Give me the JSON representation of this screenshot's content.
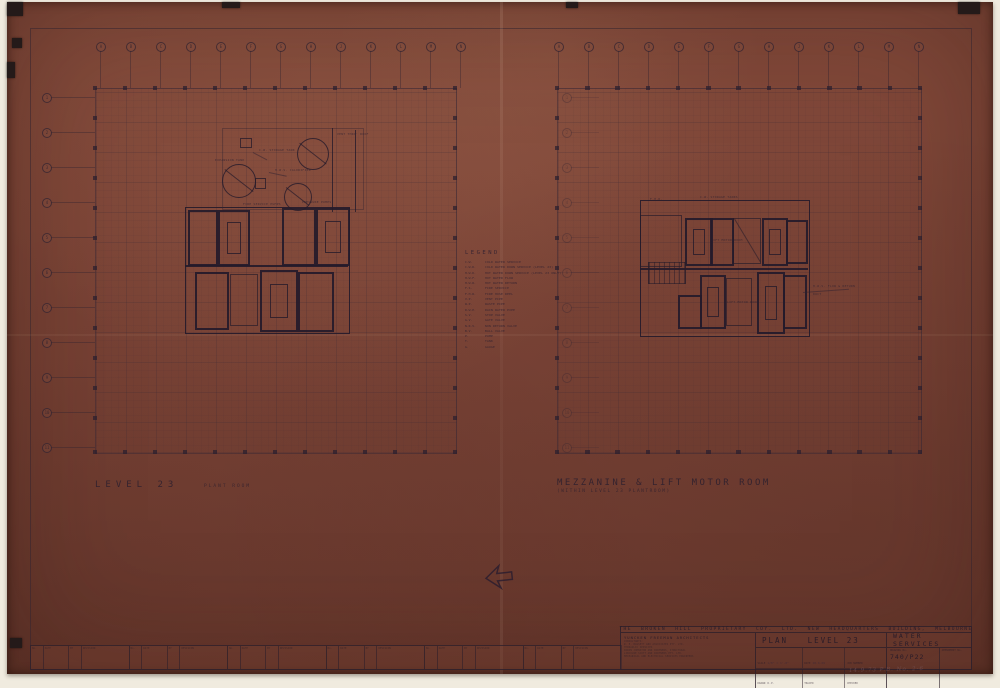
{
  "sheet": {
    "plans": {
      "left": {
        "title": "LEVEL 23",
        "subtitle": "PLANT ROOM"
      },
      "right": {
        "title": "MEZZANINE & LIFT MOTOR ROOM",
        "subtitle": "(WITHIN LEVEL 23 PLANTROOM)"
      }
    },
    "legend": {
      "title": "LEGEND",
      "entries": [
        {
          "abbr": "C.W.",
          "desc": "COLD WATER SERVICE"
        },
        {
          "abbr": "C.W.D.",
          "desc": "COLD WATER DOWN SERVICE (LEVEL 23)"
        },
        {
          "abbr": "H.W.D.",
          "desc": "HOT WATER DOWN SERVICE (LEVEL 23 ONLY)"
        },
        {
          "abbr": "H.W.F.",
          "desc": "HOT WATER FLOW"
        },
        {
          "abbr": "H.W.R.",
          "desc": "HOT WATER RETURN"
        },
        {
          "abbr": "F.S.",
          "desc": "FIRE SERVICE"
        },
        {
          "abbr": "F.H.R.",
          "desc": "FIRE HOSE REEL"
        },
        {
          "abbr": "V.P.",
          "desc": "VENT PIPE"
        },
        {
          "abbr": "W.P.",
          "desc": "WASTE PIPE"
        },
        {
          "abbr": "R.W.P.",
          "desc": "RAIN WATER PIPE"
        },
        {
          "abbr": "S.V.",
          "desc": "STOP VALVE"
        },
        {
          "abbr": "G.V.",
          "desc": "GATE VALVE"
        },
        {
          "abbr": "N.R.V.",
          "desc": "NON RETURN VALVE"
        },
        {
          "abbr": "B.V.",
          "desc": "BALL VALVE"
        },
        {
          "abbr": "P.",
          "desc": "PUMP"
        },
        {
          "abbr": "T.",
          "desc": "TANK"
        },
        {
          "abbr": "G.",
          "desc": "GAUGE"
        }
      ]
    },
    "grid": {
      "columns": [
        "A",
        "B",
        "C",
        "D",
        "E",
        "F",
        "G",
        "H",
        "J",
        "K",
        "L",
        "M",
        "N"
      ],
      "rows": [
        "1",
        "2",
        "3",
        "4",
        "5",
        "6",
        "7",
        "8",
        "9",
        "10",
        "11"
      ]
    },
    "annotations": {
      "left": [
        "C.W. STORAGE TANK",
        "H.W.S. CALORIFIER",
        "EXPANSION TANK",
        "PRESSURE PUMPS",
        "FIRE SERVICE PUMPS",
        "VENT THRO' ROOF"
      ],
      "right": [
        "C.W. STORAGE TANKS",
        "LIFT MOTOR ROOM",
        "LIFT MOTOR ROOM",
        "H.W.S. FLOW & RETURN",
        "DUCT",
        "F.H.R."
      ]
    }
  },
  "title_block": {
    "project_title": "THE BROKEN HILL PROPRIETARY COY. LTD. NEW HEADQUARTERS BUILDING, MELBOURNE",
    "architect": "YUNCKEN FREEMAN ARCHITECTS",
    "consultants": [
      "CONSULTANTS:",
      "W. E. BASSETT AND ASSOCIATES PTY. LTD.",
      "HYDRAULIC SERVICES",
      "IRWIN JOHNSTON AND PARTNERS, STRUCTURAL",
      "LINCOLNE SCOTT AND PARTNERS PTY. LTD.",
      "MECHANICAL AND ELECTRICAL SERVICES ENGINEERS"
    ],
    "drawing_title": "PLAN   LEVEL 23",
    "discipline": "WATER SERVICES",
    "fields": {
      "scale_label": "SCALE",
      "scale_value": "1/8\" = 1'-0\"",
      "date_label": "DATE",
      "date_value": "20.6.69",
      "job_label": "JOB NUMBER",
      "job_value": "",
      "drawn_label": "DRAWN",
      "drawn_value": "R.P.",
      "traced_label": "TRACED",
      "traced_value": "",
      "checked_label": "CHECKED",
      "checked_value": "",
      "drawing_no_label": "DRAWING No.",
      "drawing_no": "740/P22",
      "amendment_label": "AMENDMENT No.",
      "amendment_value": ""
    },
    "revision_headers": [
      "No.",
      "DATE",
      "BY",
      "REVISION"
    ],
    "revision_group_count": 6
  },
  "hand_note": "14.9.73  P.B. No. 2-6",
  "colors": {
    "sheet": "#7a4336",
    "ink": "#32263a",
    "margin_cream": "#f0ebdf"
  }
}
